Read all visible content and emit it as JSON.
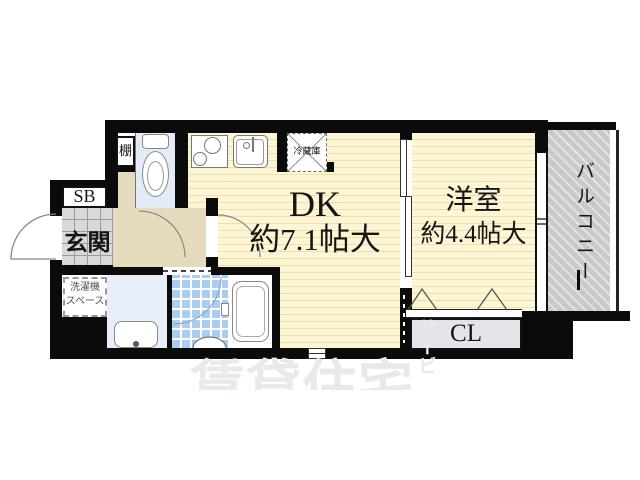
{
  "floorplan": {
    "labels": {
      "dk": "DK",
      "dk_size": "約7.1帖大",
      "west_room": "洋室",
      "west_room_size": "約4.4帖大",
      "balcony": "バルコニー",
      "entrance": "玄関",
      "shoe_box": "SB",
      "shelf": "棚",
      "fridge": "冷蔵庫",
      "washer_line1": "洗濯機",
      "washer_line2": "スペース",
      "closet": "CL"
    },
    "watermark": {
      "main": "賃貸住宅",
      "sub": "サービス"
    },
    "colors": {
      "wall": "#0b0b0b",
      "floor_yellow": "#fcf5d6",
      "floor_stripe": "#f1dfa4",
      "hallway_beige": "#e6dabc",
      "bath_tile_blue": "#a9cdf1",
      "toilet_floor": "#e3ebf7",
      "balcony_gray": "#c9c9c9",
      "closet_fill": "#e7e3eb",
      "entrance_tile": "#d9d9d9",
      "watermark_gray": "#e9e9e6"
    }
  }
}
